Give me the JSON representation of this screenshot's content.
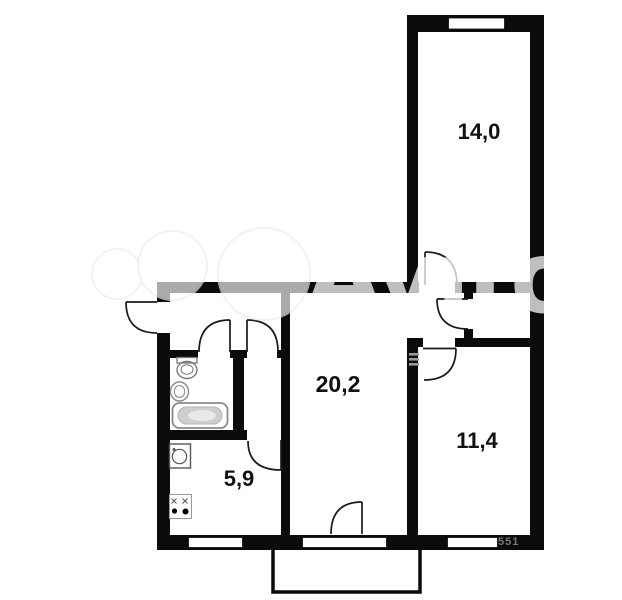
{
  "floor_plan": {
    "rooms": [
      {
        "key": "bedroom_top",
        "area_label": "14,0"
      },
      {
        "key": "living_room",
        "area_label": "20,2"
      },
      {
        "key": "bedroom_right",
        "area_label": "11,4"
      },
      {
        "key": "kitchen",
        "area_label": "5,9"
      }
    ],
    "fixtures": [
      "toilet",
      "wash-basin",
      "bathtub",
      "kitchen-sink",
      "stove",
      "vent-hatch"
    ],
    "corner_note": "551",
    "colors": {
      "wall": "#0b0b0b",
      "background": "#ffffff",
      "fixture_gray": "#8a8a8a"
    }
  },
  "watermark": {
    "text": "Avito"
  }
}
